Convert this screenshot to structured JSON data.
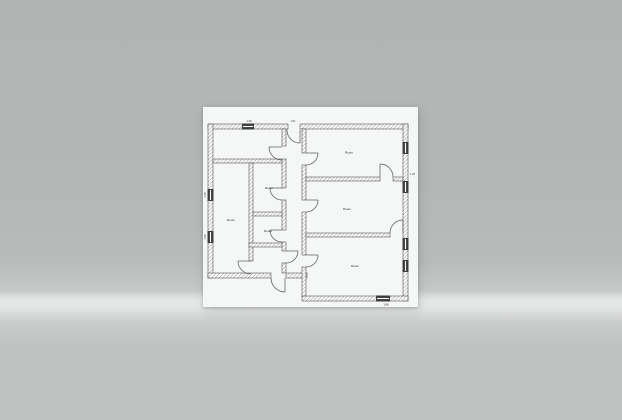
{
  "scene": {
    "type": "architectural floor plan sheet on gray studio backdrop",
    "backdrop_top_color": "#b3b5b5",
    "backdrop_band_color": "#e7e8e8",
    "backdrop_bottom_color": "#c0c2c2",
    "sheet_color": "#f5f6f6",
    "ink_color": "#3d3d3d"
  },
  "plan": {
    "room_labels": {
      "top_right": "Room",
      "middle_right": "Room",
      "bottom_right": "Room",
      "left_large": "Room",
      "small_top": "Room",
      "small_bottom": "Room"
    },
    "dimension_labels": {
      "top_window": "1.26",
      "entrance": "1.01",
      "left_window_upper": "1.26",
      "left_window_lower": "1.26",
      "right_wall": "1.26",
      "bottom_window": "1.88"
    }
  }
}
